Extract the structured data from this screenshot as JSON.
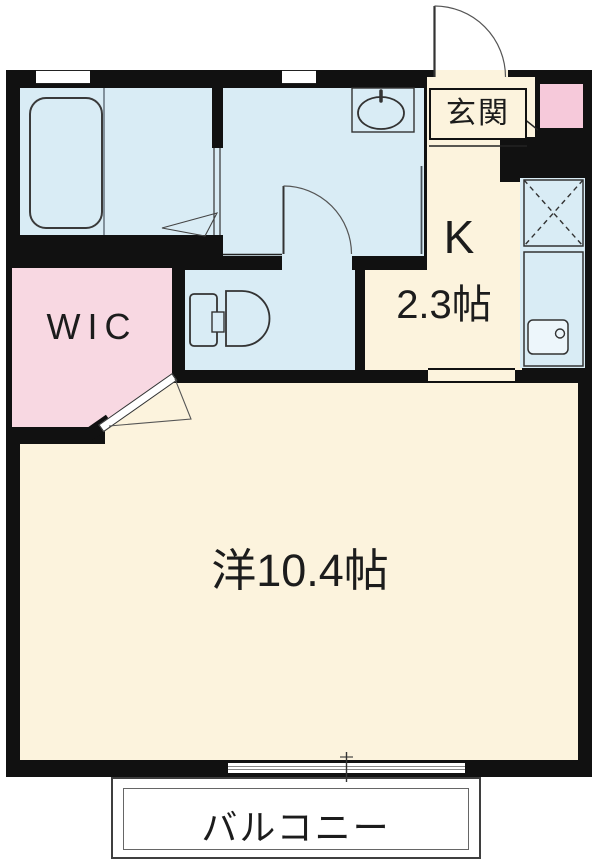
{
  "labels": {
    "entrance": "玄関",
    "kitchen": "K",
    "kitchen_size": "2.3帖",
    "wic": "WIC",
    "main_room": "洋10.4帖",
    "balcony": "バルコニー"
  },
  "colors": {
    "wall": "#111111",
    "wet_area_blue": "#d9ecf5",
    "wic_pink": "#f8d8e2",
    "cabinet_pink": "#f6c9da",
    "floor_cream": "#fcf3dd",
    "fixture_line": "#333333"
  }
}
